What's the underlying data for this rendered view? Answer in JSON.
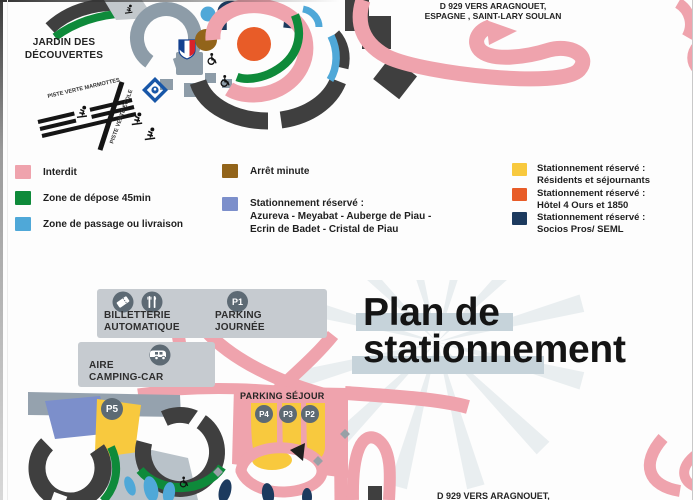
{
  "colors": {
    "road_forbidden_pink": "#efa3ad",
    "path_dark_gray": "#3f3f3f",
    "ring_road_gray": "#8d9ca8",
    "info_box_gray": "#c6cbd0",
    "badge_gray": "#5d6a74",
    "title_highlight": "#c6d3da",
    "green_zone": "#0e8a3a",
    "blue_zone": "#4fa8d8",
    "yellow_zone": "#f8c93e",
    "orange_zone": "#e85c28",
    "navy_zone": "#1c3a5e",
    "brown_zone": "#92641a",
    "periwinkle_zone": "#7c8fcb"
  },
  "icons": {
    "ticket": "ticket-icon",
    "restaurant": "utensils-icon",
    "camper": "camper-icon",
    "skier": "skier-icon",
    "wheelchair": "wheelchair-icon",
    "club_shield": "club-shield-icon",
    "village_emblem": "village-emblem-icon",
    "direction_arrow": "direction-arrow-icon"
  },
  "top_map": {
    "jardin_line1": "JARDIN DES",
    "jardin_line2": "DÉCOUVERTES",
    "piste_marmottes": "PISTE VERTE MARMOTTES",
    "piste_ecole": "PISTE VERTE ÉCOLE",
    "d929_line1": "D 929 VERS ARAGNOUET,",
    "d929_line2": "ESPAGNE , SAINT-LARY SOULAN"
  },
  "legend": {
    "items": [
      {
        "color": "#efa3ad",
        "lines": [
          "Interdit"
        ]
      },
      {
        "color": "#0e8a3a",
        "lines": [
          "Zone de dépose 45min"
        ]
      },
      {
        "color": "#4fa8d8",
        "lines": [
          "Zone de passage ou livraison"
        ]
      },
      {
        "color": "#92641a",
        "lines": [
          "Arrêt minute"
        ]
      },
      {
        "color": "#7c8fcb",
        "lines": [
          "Stationnement réservé :",
          "Azureva - Meyabat - Auberge de Piau -",
          "Ecrin de Badet - Cristal de Piau"
        ]
      },
      {
        "color": "#f8c93e",
        "lines": [
          "Stationnement réservé :",
          "Résidents et séjournants"
        ]
      },
      {
        "color": "#e85c28",
        "lines": [
          "Stationnement réservé :",
          "Hôtel 4 Ours et 1850"
        ]
      },
      {
        "color": "#1c3a5e",
        "lines": [
          "Stationnement réservé :",
          "Socios Pros/ SEML"
        ]
      }
    ]
  },
  "bottom_map": {
    "title_line1": "Plan de",
    "title_line2": "stationnement",
    "billetterie_line1": "BILLETTERIE",
    "billetterie_line2": "AUTOMATIQUE",
    "parking_journee_line1": "PARKING",
    "parking_journee_line2": "JOURNÉE",
    "p1": "P1",
    "aire_line1": "AIRE",
    "aire_line2": "CAMPING-CAR",
    "p5": "P5",
    "parking_sejour_label": "PARKING SÉJOUR",
    "p4": "P4",
    "p3": "P3",
    "p2": "P2",
    "d929_label": "D 929 VERS ARAGNOUET,"
  }
}
